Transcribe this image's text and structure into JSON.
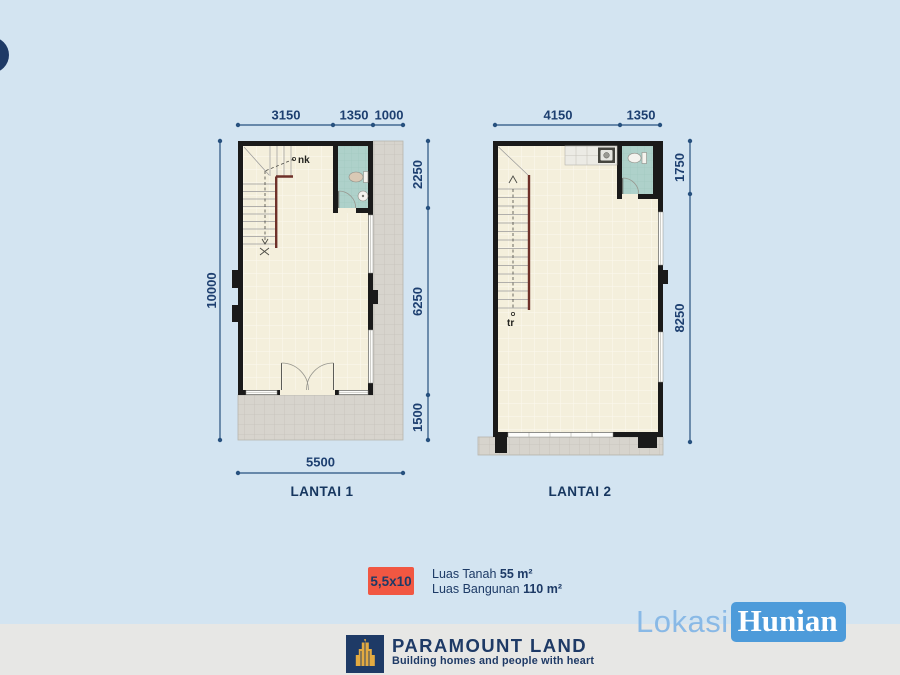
{
  "floor1": {
    "label": "LANTAI 1",
    "dims_top": [
      "3150",
      "1350",
      "1000"
    ],
    "dim_left": "10000",
    "dims_right": [
      "2250",
      "6250",
      "1500"
    ],
    "dim_bottom": "5500",
    "stair_label": "nk"
  },
  "floor2": {
    "label": "LANTAI 2",
    "dims_top": [
      "4150",
      "1350"
    ],
    "dims_right": [
      "1750",
      "8250"
    ],
    "stair_label": "tr"
  },
  "summary": {
    "size_badge": "5,5x10",
    "land_label": "Luas Tanah",
    "land_value": "55 m²",
    "building_label": "Luas Bangunan",
    "building_value": "110 m²"
  },
  "footer": {
    "brand": "PARAMOUNT LAND",
    "tagline": "Building homes and people with heart"
  },
  "watermark": {
    "part1": "Lokasi",
    "part2": "Hunian"
  },
  "colors": {
    "background": "#d3e4f1",
    "accent_navy": "#1d3a66",
    "dimension_navy": "#27517f",
    "badge_red": "#f15742",
    "watermark_blue": "#4d9bda",
    "wall_black": "#1a1a1a",
    "floor_cream": "#f4efdc",
    "paving_gray": "#d7d4cd",
    "bathroom_teal": "#aed1ca",
    "railing_maroon": "#6e3028",
    "footer_band": "#e7e7e5"
  }
}
